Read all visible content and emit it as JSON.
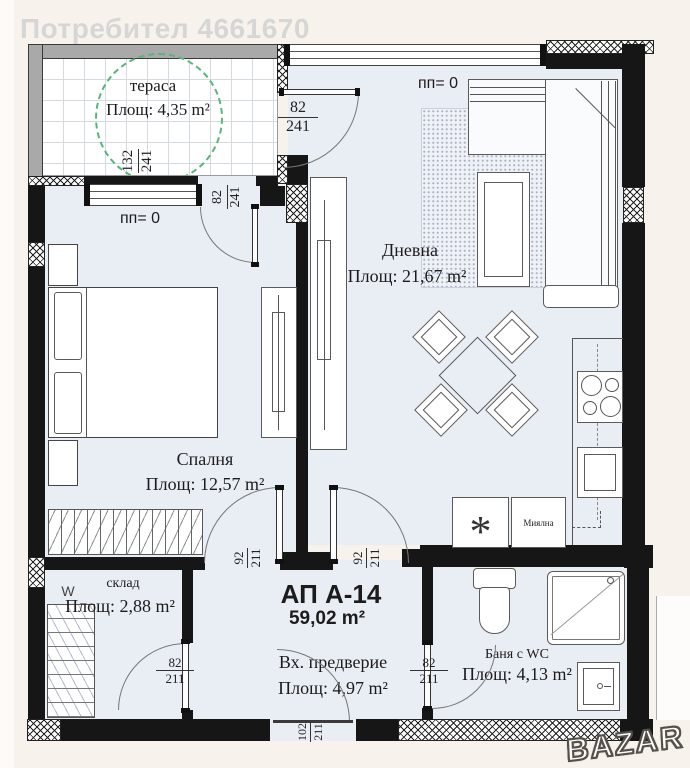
{
  "watermark": {
    "user": "Потребител 4661670",
    "brand": "BAZAR"
  },
  "apartment": {
    "code": "АП А-14",
    "total_area": "59,02 m²"
  },
  "rooms": {
    "terrace": {
      "name": "тераса",
      "area": "Площ: 4,35 m²"
    },
    "living": {
      "name": "Дневна",
      "area": "Площ: 21,67 m²"
    },
    "bedroom": {
      "name": "Спалня",
      "area": "Площ: 12,57 m²"
    },
    "storage": {
      "name": "склад",
      "area": "Площ: 2,88 m²",
      "mark": "W"
    },
    "hall": {
      "name": "Вх. предверие",
      "area": "Площ: 4,97 m²"
    },
    "bathroom": {
      "name": "Баня с WC",
      "area": "Площ: 4,13 m²"
    }
  },
  "labels": {
    "window": "пп= 0",
    "dishwasher": "Миялна",
    "washer_symbol": "*"
  },
  "dimensions": {
    "terrace_side": {
      "w": "132",
      "h": "241"
    },
    "terrace_door_living": {
      "w": "82",
      "h": "241"
    },
    "terrace_door_bedroom": {
      "w": "82",
      "h": "241"
    },
    "door_bedroom": {
      "w": "92",
      "h": "211"
    },
    "door_living": {
      "w": "92",
      "h": "211"
    },
    "door_storage": {
      "w": "82",
      "h": "211"
    },
    "door_bathroom": {
      "w": "82",
      "h": "211"
    },
    "door_entrance": {
      "w": "102",
      "h": "211"
    }
  },
  "colors": {
    "wall": "#161616",
    "floor": "#e9edf4",
    "terrace_circle": "#58b57c",
    "parapet": "#a9a9a9",
    "background": "#f7f3ec"
  }
}
